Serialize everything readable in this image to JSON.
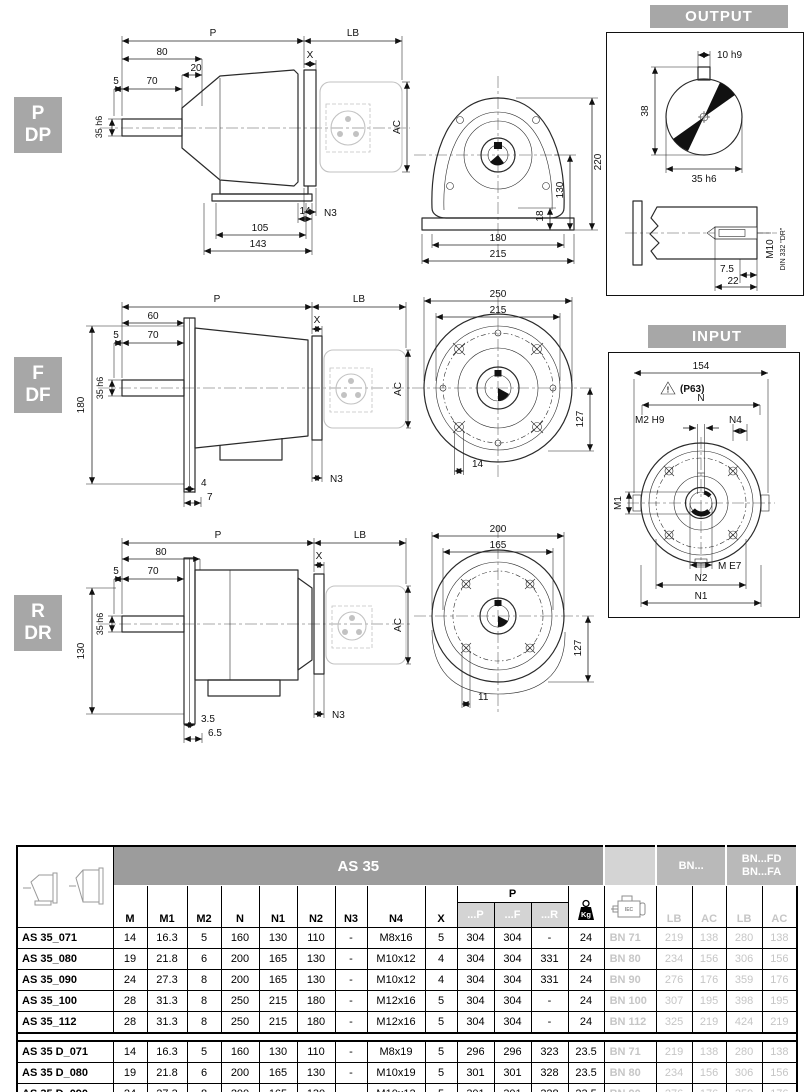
{
  "bands": {
    "output": "OUTPUT",
    "input": "INPUT"
  },
  "sections": {
    "pdp": {
      "l1": "P",
      "l2": "DP",
      "side": {
        "p": "P",
        "lb": "LB",
        "a": "80",
        "b": "20",
        "x": "X",
        "c": "5",
        "d": "70",
        "shaft": "35 h6",
        "ac": "AC",
        "n3": "N3",
        "e": "14",
        "f": "105",
        "g": "143"
      },
      "front": {
        "a": "220",
        "b": "130",
        "c": "18",
        "d": "180",
        "e": "215"
      }
    },
    "fdf": {
      "l1": "F",
      "l2": "DF",
      "side": {
        "p": "P",
        "lb": "LB",
        "a": "60",
        "x": "X",
        "c": "5",
        "d": "70",
        "shaft": "35 h6",
        "h": "180",
        "ac": "AC",
        "n3": "N3",
        "e": "4",
        "f": "7"
      },
      "front": {
        "a": "250",
        "b": "215",
        "c": "127",
        "d": "14"
      }
    },
    "rdr": {
      "l1": "R",
      "l2": "DR",
      "side": {
        "p": "P",
        "lb": "LB",
        "a": "80",
        "x": "X",
        "c": "5",
        "d": "70",
        "shaft": "35 h6",
        "h": "130",
        "ac": "AC",
        "n3": "N3",
        "e": "3.5",
        "f": "6.5"
      },
      "front": {
        "a": "200",
        "b": "165",
        "c": "127",
        "d": "11"
      }
    }
  },
  "output_box": {
    "key": "10 h9",
    "over": "38",
    "dia": "35 h6",
    "t1": "7.5",
    "t2": "22",
    "thread": "M10",
    "din": "DIN 332 \"DR\""
  },
  "input_box": {
    "w": "154",
    "warn": "!",
    "p63": "(P63)",
    "n": "N",
    "m2": "M2 H9",
    "n4": "N4",
    "m1": "M1",
    "m": "M E7",
    "n2": "N2",
    "n1": "N1"
  },
  "table": {
    "title": "AS 35",
    "cols": [
      "M",
      "M1",
      "M2",
      "N",
      "N1",
      "N2",
      "N3",
      "N4",
      "X"
    ],
    "p_label": "P",
    "p_cols": [
      "...P",
      "...F",
      "...R"
    ],
    "kg": "Kg",
    "motor_text": "IEC",
    "bn": "BN...",
    "bnfd1": "BN...FD",
    "bnfd2": "BN...FA",
    "lbac": [
      "LB",
      "AC",
      "LB",
      "AC"
    ],
    "groups": [
      [
        [
          "AS 35_071",
          "14",
          "16.3",
          "5",
          "160",
          "130",
          "110",
          "-",
          "M8x16",
          "5",
          "304",
          "304",
          "-",
          "24",
          "BN 71",
          "219",
          "138",
          "280",
          "138"
        ],
        [
          "AS 35_080",
          "19",
          "21.8",
          "6",
          "200",
          "165",
          "130",
          "-",
          "M10x12",
          "4",
          "304",
          "304",
          "331",
          "24",
          "BN 80",
          "234",
          "156",
          "306",
          "156"
        ],
        [
          "AS 35_090",
          "24",
          "27.3",
          "8",
          "200",
          "165",
          "130",
          "-",
          "M10x12",
          "4",
          "304",
          "304",
          "331",
          "24",
          "BN 90",
          "276",
          "176",
          "359",
          "176"
        ],
        [
          "AS 35_100",
          "28",
          "31.3",
          "8",
          "250",
          "215",
          "180",
          "-",
          "M12x16",
          "5",
          "304",
          "304",
          "-",
          "24",
          "BN 100",
          "307",
          "195",
          "398",
          "195"
        ],
        [
          "AS 35_112",
          "28",
          "31.3",
          "8",
          "250",
          "215",
          "180",
          "-",
          "M12x16",
          "5",
          "304",
          "304",
          "-",
          "24",
          "BN 112",
          "325",
          "219",
          "424",
          "219"
        ]
      ],
      [
        [
          "AS 35 D_071",
          "14",
          "16.3",
          "5",
          "160",
          "130",
          "110",
          "-",
          "M8x19",
          "5",
          "296",
          "296",
          "323",
          "23.5",
          "BN 71",
          "219",
          "138",
          "280",
          "138"
        ],
        [
          "AS 35 D_080",
          "19",
          "21.8",
          "6",
          "200",
          "165",
          "130",
          "-",
          "M10x19",
          "5",
          "301",
          "301",
          "328",
          "23.5",
          "BN 80",
          "234",
          "156",
          "306",
          "156"
        ],
        [
          "AS 35 D_090",
          "24",
          "27.3",
          "8",
          "200",
          "165",
          "130",
          "-",
          "M10x12",
          "5",
          "301",
          "301",
          "328",
          "23.5",
          "BN 90",
          "276",
          "176",
          "359",
          "176"
        ]
      ]
    ]
  }
}
